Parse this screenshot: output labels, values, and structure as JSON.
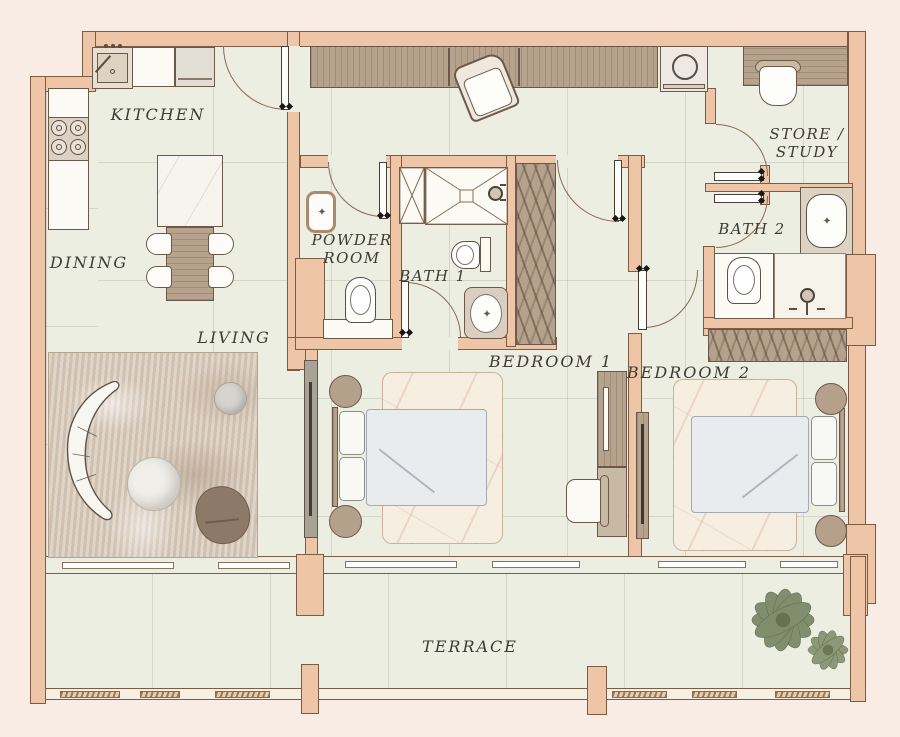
{
  "rooms": {
    "kitchen": {
      "label": "KITCHEN"
    },
    "dining": {
      "label": "DINING"
    },
    "living": {
      "label": "LIVING"
    },
    "powder_room": {
      "line1": "POWDER",
      "line2": "ROOM"
    },
    "bath1": {
      "label": "BATH 1"
    },
    "store_study": {
      "line1": "STORE /",
      "line2": "STUDY"
    },
    "bath2": {
      "label": "BATH 2"
    },
    "bedroom1": {
      "label": "BEDROOM 1"
    },
    "bedroom2": {
      "label": "BEDROOM 2"
    },
    "terrace": {
      "label": "TERRACE"
    }
  },
  "colors": {
    "background": "#f8ece4",
    "wall": "#eec5a6",
    "wall_outline": "#7d5c44",
    "floor": "#eceee2",
    "wood": "#b7a28d",
    "accent_text": "#3e3b35"
  }
}
